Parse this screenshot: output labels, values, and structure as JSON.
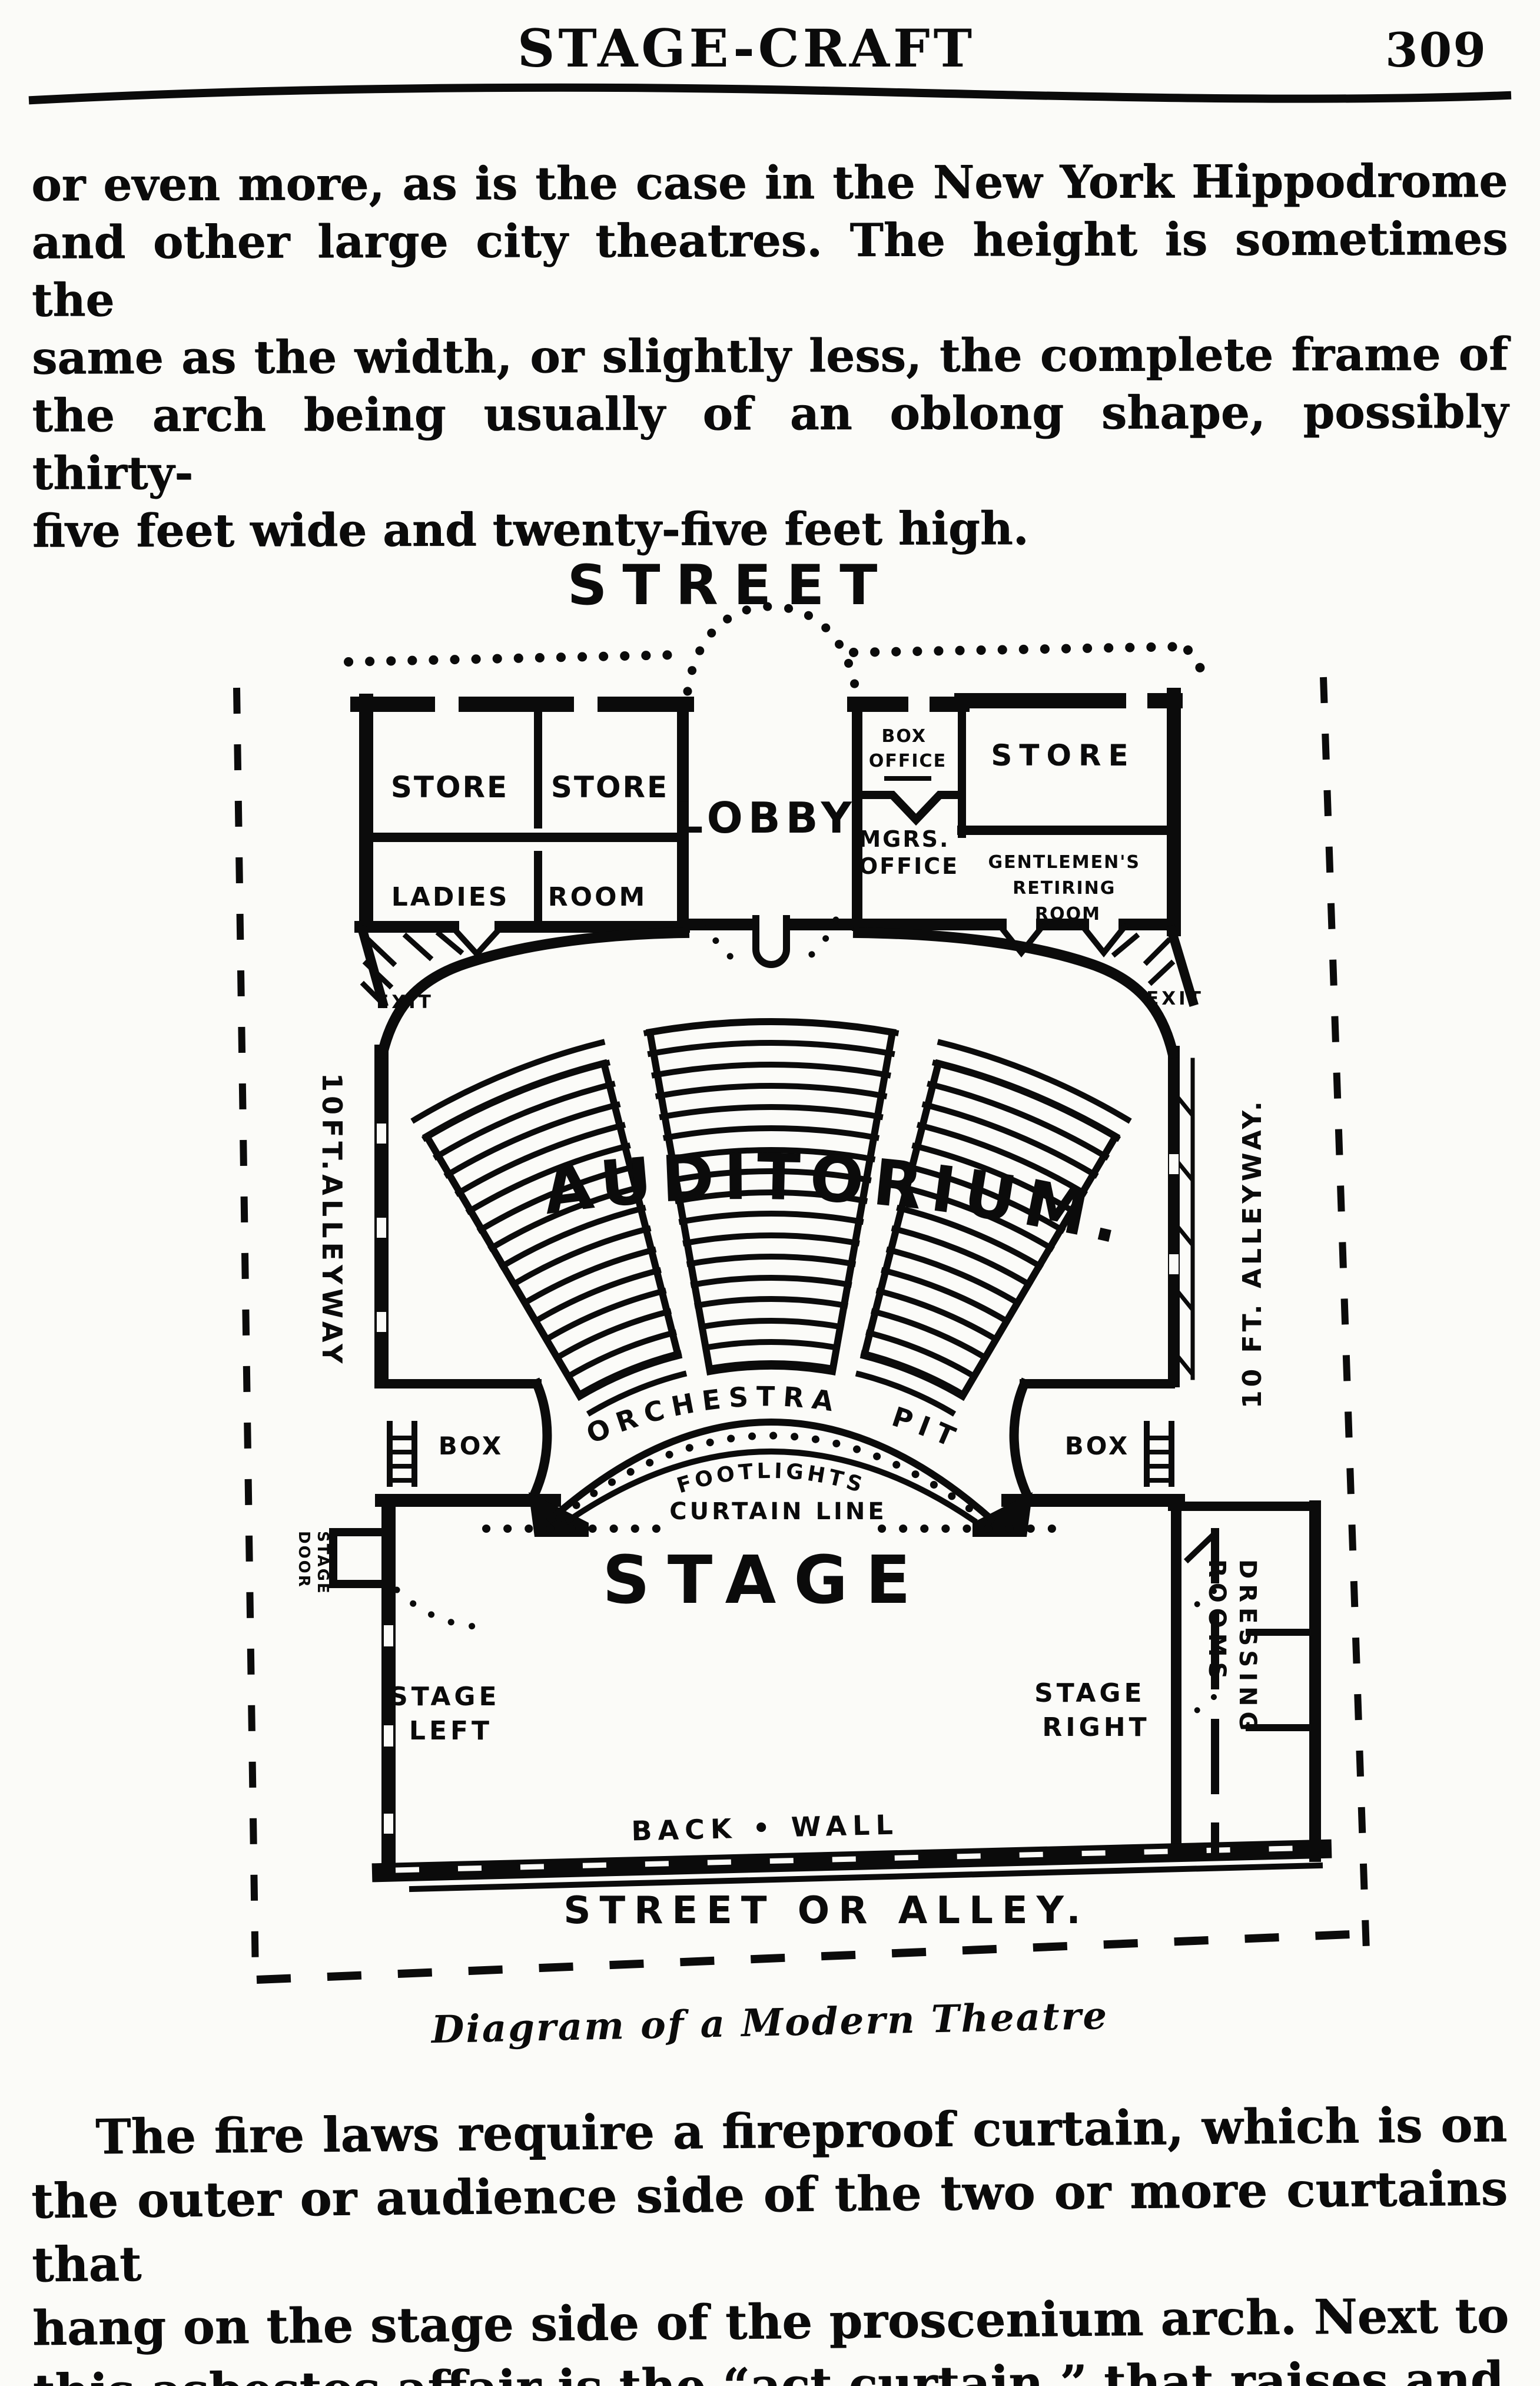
{
  "header": {
    "title": "STAGE-CRAFT",
    "page_number": "309"
  },
  "intro_paragraph": {
    "lines": [
      "or even more, as is the case in the New York Hippodrome",
      "and other large city theatres.  The height is sometimes the",
      "same as the width, or slightly less, the complete frame of",
      "the arch being usually of an oblong shape, possibly thirty-",
      "five feet wide and twenty-five feet high."
    ]
  },
  "diagram": {
    "street": "STREET",
    "shops": {
      "store_left_a": "STORE",
      "store_left_b": "STORE",
      "ladies_room": "LADIES ROOM",
      "lobby": "LOBBY",
      "box_office": [
        "BOX",
        "OFFICE"
      ],
      "store_right": "STORE",
      "managers_office": [
        "MGRS.",
        "OFFICE"
      ],
      "gentlemens_retiring_room": [
        "GENTLEMEN'S",
        "RETIRING",
        "ROOM"
      ]
    },
    "auditorium": {
      "label": "AUDITORIUM.",
      "exit_left": "EXIT",
      "exit_right": "EXIT",
      "orchestra_pit": "ORCHESTRA PIT",
      "box_left": "BOX",
      "box_right": "BOX",
      "footlights": "FOOTLIGHTS",
      "curtain_line": "CURTAIN LINE"
    },
    "alleys": {
      "left": "10FT.ALLEYWAY",
      "right": "10 FT. ALLEYWAY.",
      "street_or_alley": "STREET OR ALLEY."
    },
    "stage": {
      "label": "STAGE",
      "stage_left": [
        "STAGE",
        "LEFT"
      ],
      "stage_right": [
        "STAGE",
        "RIGHT"
      ],
      "stage_door": [
        "STAGE",
        "DOOR"
      ],
      "dressing_rooms": [
        "DRESSING",
        "ROOMS"
      ],
      "back_wall": "BACK • WALL"
    }
  },
  "caption": "Diagram of a Modern Theatre",
  "closing_paragraph": {
    "lines": [
      "The fire laws require a fireproof curtain, which is on",
      "the outer or audience side of the two or more curtains that",
      "hang on the stage side of the proscenium arch.  Next to",
      "this asbestos affair is the “act curtain,” that raises and"
    ]
  }
}
